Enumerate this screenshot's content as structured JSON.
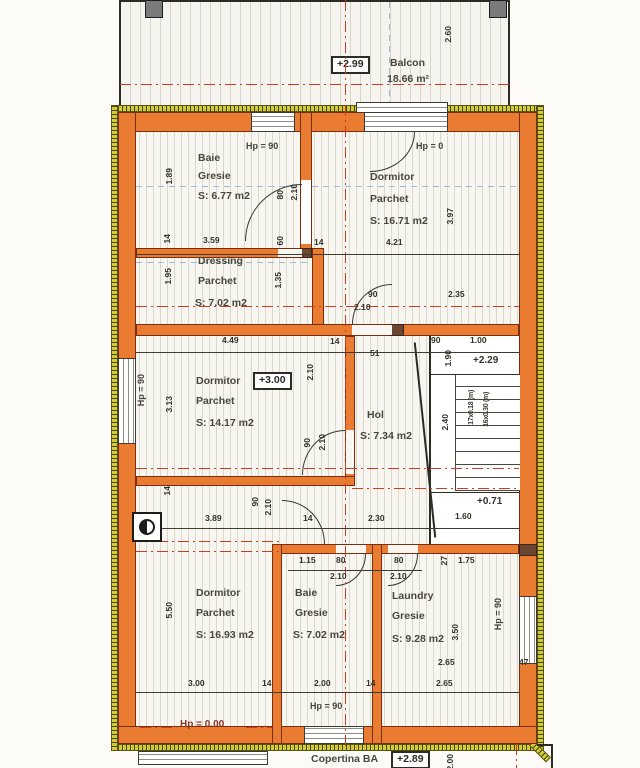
{
  "balcony": {
    "level": "+2.99",
    "name": "Balcon",
    "area": "18.66 m²",
    "depth": "2.60"
  },
  "markers": {
    "hp90": "Hp = 90",
    "hp0": "Hp = 0",
    "hp000": "Hp = 0.00",
    "lvl300": "+3.00",
    "lvl229": "+2.29",
    "lvl071": "+0.71"
  },
  "rooms": {
    "baie1": {
      "l1": "Baie",
      "l2": "Gresie",
      "l3": "S: 6.77 m2"
    },
    "dorm1": {
      "l1": "Dormitor",
      "l2": "Parchet",
      "l3": "S: 16.71 m2"
    },
    "dressing": {
      "l1": "Dressing",
      "l2": "Parchet",
      "l3": "S: 7.02 m2"
    },
    "dorm2": {
      "l1": "Dormitor",
      "l2": "Parchet",
      "l3": "S: 14.17 m2"
    },
    "hol": {
      "l1": "Hol",
      "l3": "S: 7.34 m2"
    },
    "dorm3": {
      "l1": "Dormitor",
      "l2": "Parchet",
      "l3": "S: 16.93 m2"
    },
    "baie2": {
      "l1": "Baie",
      "l2": "Gresie",
      "l3": "S: 7.02 m2"
    },
    "laundry": {
      "l1": "Laundry",
      "l2": "Gresie",
      "l3": "S: 9.28 m2"
    }
  },
  "stair": {
    "t1": "17x0.18 (m)",
    "t2": "16x0.30 (m)",
    "w": "2.40",
    "run": "1.60",
    "landing": "1.90"
  },
  "dims": {
    "v189": "1.89",
    "v359": "3.59",
    "v60": "60",
    "v14": "14",
    "v195": "1.95",
    "v135": "1.35",
    "v421": "4.21",
    "v397": "3.97",
    "v235": "2.35",
    "v449": "4.49",
    "v90": "90",
    "v100": "1.00",
    "v51": "51",
    "v210": "2.10",
    "v80": "80",
    "v313": "3.13",
    "v389": "3.89",
    "v230": "2.30",
    "v550": "5.50",
    "v115": "1.15",
    "v27": "27",
    "v175": "1.75",
    "v350": "3.50",
    "v265": "2.65",
    "v47": "47",
    "v300": "3.00",
    "v200": "2.00",
    "v160": "1.60",
    "v260": "2.60"
  },
  "footer": {
    "label": "Copertina BA",
    "level": "+2.89",
    "dim": "2.00"
  }
}
